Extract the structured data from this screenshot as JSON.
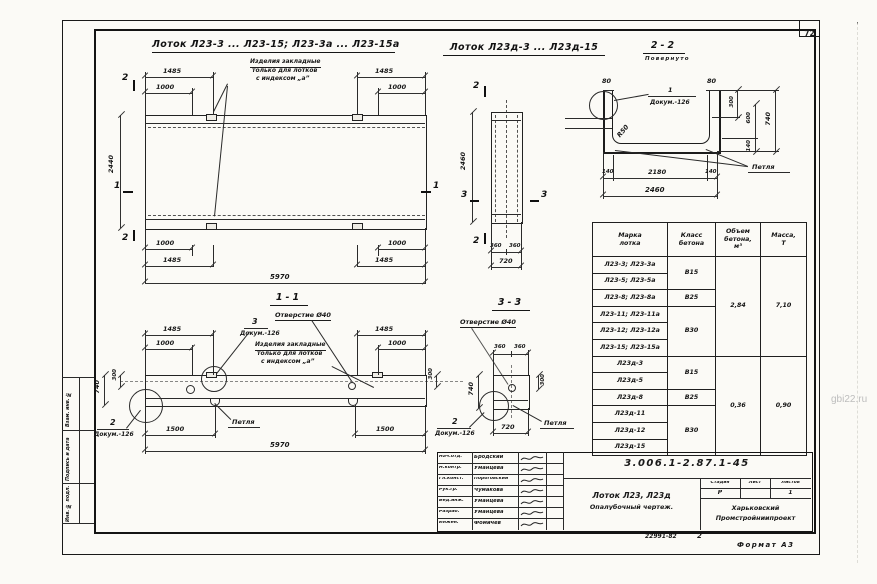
{
  "sheet": {
    "page_number": "72",
    "watermark": "gbi22.ru",
    "format": "Формат А3",
    "footer_code": "22991-82",
    "footer_num": "2"
  },
  "titles": {
    "view_main": "Лоток Л23-3 ... Л23-15; Л23-3а ... Л23-15а",
    "view_d": "Лоток Л23д-3 ... Л23д-15",
    "section_22": "2-2",
    "section_22_note": "Повернуто",
    "section_11": "1-1",
    "section_33": "3-3"
  },
  "labels": {
    "embed_note_1": "Изделия закладные",
    "embed_note_2": "только для лотков",
    "embed_note_3": "с индексом „а”",
    "hole": "Отверстие Ø40",
    "loop": "Петля",
    "doc_ref": "Докум.-126",
    "radius": "R50",
    "callout_1": "1",
    "callout_2": "2",
    "callout_3": "3",
    "mark_1": "1",
    "mark_2": "2",
    "mark_3": "3"
  },
  "dims": {
    "plan": {
      "t1485": "1485",
      "t1000": "1000",
      "height": "2440",
      "b1000": "1000",
      "b1485": "1485",
      "overall": "5970"
    },
    "plan_d": {
      "height": "2460",
      "b360": "360",
      "overall": "720"
    },
    "s22": {
      "wall": "80",
      "r300": "300",
      "r600": "600",
      "r140": "140",
      "r740": "740",
      "b140": "140",
      "b2180": "2180",
      "overall": "2460"
    },
    "s11": {
      "t1485": "1485",
      "t1000": "1000",
      "l300": "300",
      "l740": "740",
      "r300": "300",
      "b1500": "1500",
      "overall": "5970"
    },
    "s33": {
      "t360": "360",
      "l740": "740",
      "r300": "300",
      "overall": "720"
    }
  },
  "table": {
    "headers": [
      "Марка\nлотка",
      "Класс\nбетона",
      "Объем\nбетона,\nм³",
      "Масса,\nТ"
    ],
    "rows": [
      "Л23-3; Л23-3а",
      "Л23-5; Л23-5а",
      "Л23-8; Л23-8а",
      "Л23-11; Л23-11а",
      "Л23-12; Л23-12а",
      "Л23-15; Л23-15а",
      "Л23д-3",
      "Л23д-5",
      "Л23д-8",
      "Л23д-11",
      "Л23д-12",
      "Л23д-15"
    ],
    "classes": {
      "g1": "В15",
      "g2": "В25",
      "g3": "В30",
      "g4": "В15",
      "g5": "В25",
      "g6": "В30"
    },
    "volume": {
      "g1": "2,84",
      "g2": "0,36"
    },
    "mass": {
      "g1": "7,10",
      "g2": "0,90"
    }
  },
  "titleblock": {
    "doc_number": "3.006.1-2.87.1-45",
    "product": "Лоток Л23, Л23д",
    "drawing_type": "Опалубочный чертеж.",
    "stage_label": "Стадия",
    "sheet_label": "Лист",
    "sheets_label": "Листов",
    "stage": "Р",
    "sheet": "",
    "sheets": "1",
    "org_line1": "Харьковский",
    "org_line2": "Промстройниипроект",
    "staff": [
      {
        "role": "Нач.отд.",
        "name": "Бродский"
      },
      {
        "role": "Н.контр.",
        "name": "Уманцева"
      },
      {
        "role": "Гл.конст.",
        "name": "Пороговский"
      },
      {
        "role": "Рук.гр.",
        "name": "Чумакова"
      },
      {
        "role": "Вед.инж.",
        "name": "Уманцева"
      },
      {
        "role": "Разраб.",
        "name": "Уманцева"
      },
      {
        "role": "Инжен.",
        "name": "Фомичев"
      }
    ]
  },
  "margin_stamps": {
    "s1": "Взам. инв. №",
    "s2": "Подпись и дата",
    "s3": "Инв. № подл."
  }
}
